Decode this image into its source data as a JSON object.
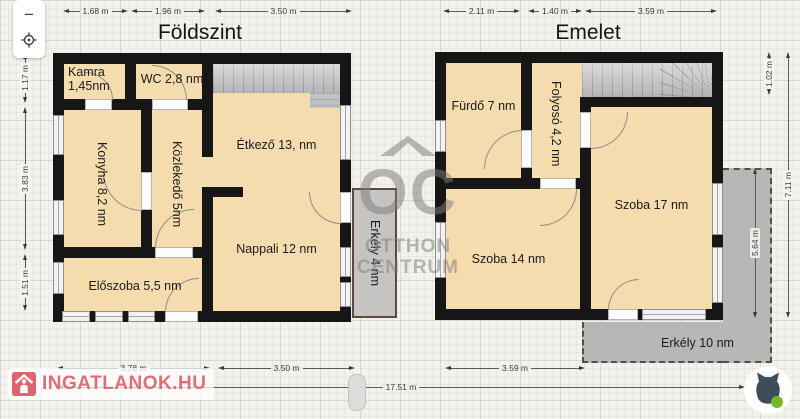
{
  "toolbar": {
    "zoom_out_label": "−"
  },
  "titles": {
    "ground": "Földszint",
    "upper": "Emelet"
  },
  "rooms": {
    "kamra": "Kamra 1,45nm",
    "wc": "WC 2,8 nm",
    "konyha": "Konyha 8,2 nm",
    "kozlekedo": "Közlekedő 5nm",
    "etkezo": "Étkező 13, nm",
    "nappali": "Nappali 12 nm",
    "eloszoba": "Előszoba 5,5 nm",
    "erkely_ground": "Erkély 4 nm",
    "furdo": "Fürdő 7 nm",
    "folyoso": "Folyosó 4,2 nm",
    "szoba17": "Szoba 17 nm",
    "szoba14": "Szoba 14 nm",
    "erkely_upper": "Erkély 10 nm"
  },
  "dims": {
    "g_top1": "1.68 m",
    "g_top2": "1.96 m",
    "g_top3": "3.50 m",
    "u_top1": "2.11 m",
    "u_top2": "1.40 m",
    "u_top3": "3.59 m",
    "left1": "1.17 m",
    "left2": "3.83 m",
    "left3": "1.51 m",
    "right_small": "1.02 m",
    "right_mid": "5.64 m",
    "right_full": "7.11 m",
    "b_g1": "3.78 m",
    "b_g2": "3.50 m",
    "b_u1": "3.59 m",
    "total": "17.51 m"
  },
  "watermark": {
    "initials": "OC",
    "line1": "OTTHON",
    "line2": "CENTRUM"
  },
  "branding": {
    "site": "INGATLANOK.HU"
  },
  "colors": {
    "room_fill": "#f5dcae",
    "wall": "#161616",
    "balcony_border": "#5a4a40",
    "balcony_fill": "#b8b7b5",
    "logo_red": "#dd6570",
    "cat_green": "#76b82a",
    "cat_head": "#3e4d5a",
    "watermark_gray": "#7d7d7d"
  }
}
